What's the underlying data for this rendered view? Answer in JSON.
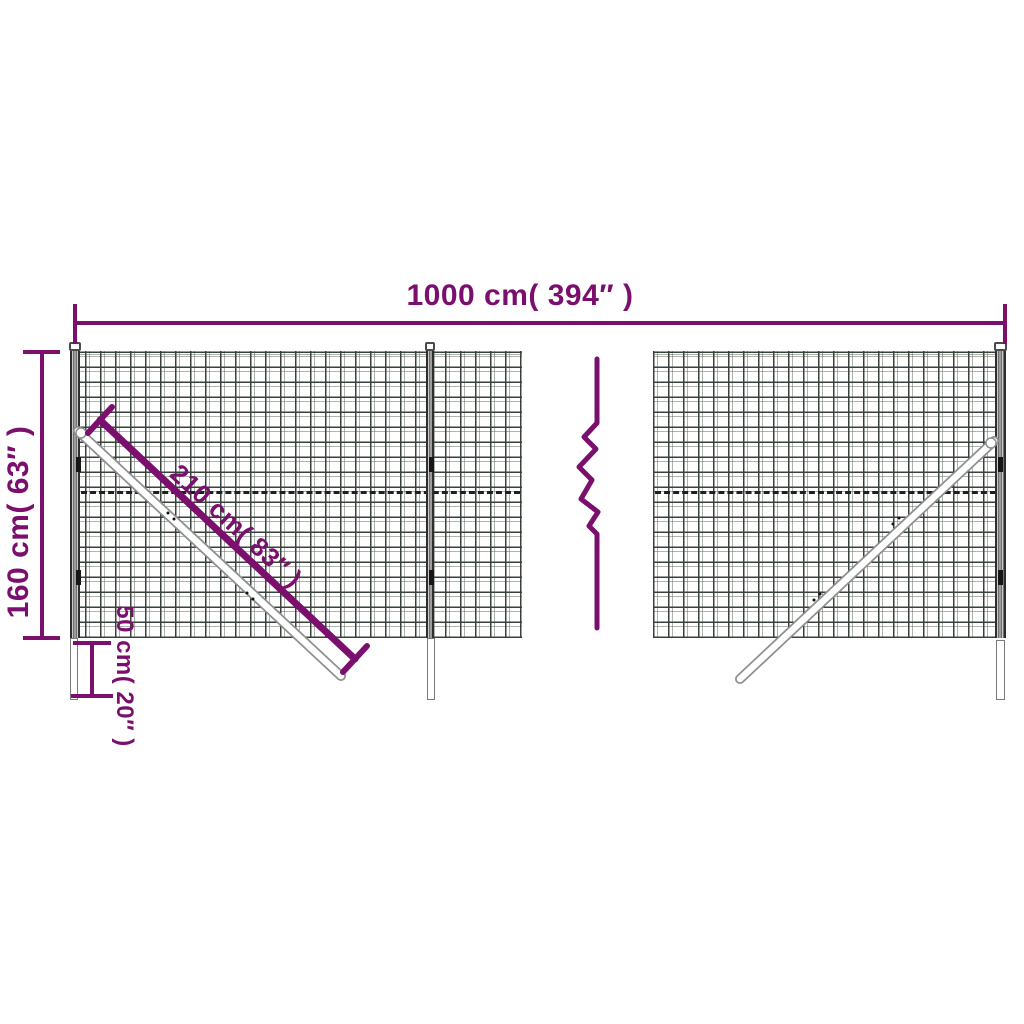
{
  "theme": {
    "accent": "#7B0F6E",
    "mesh_line": "#39423A",
    "dash_color": "#1F1F1F",
    "post_edge": "#2E2E2E",
    "bg": "#FFFFFF"
  },
  "dimensions": {
    "width_label": "1000 cm( 394″ )",
    "height_label": "160 cm( 63″ )",
    "brace_label": "210 cm( 83″ )",
    "ground_depth_label": "50 cm( 20″ )"
  },
  "figure": {
    "type": "wire-mesh-fence-dimension-diagram",
    "panels": 2,
    "posts": 3,
    "diagonal_braces": 2,
    "break_symbol": "zigzag-continuation",
    "fold_line": "dashed-horizontal"
  }
}
